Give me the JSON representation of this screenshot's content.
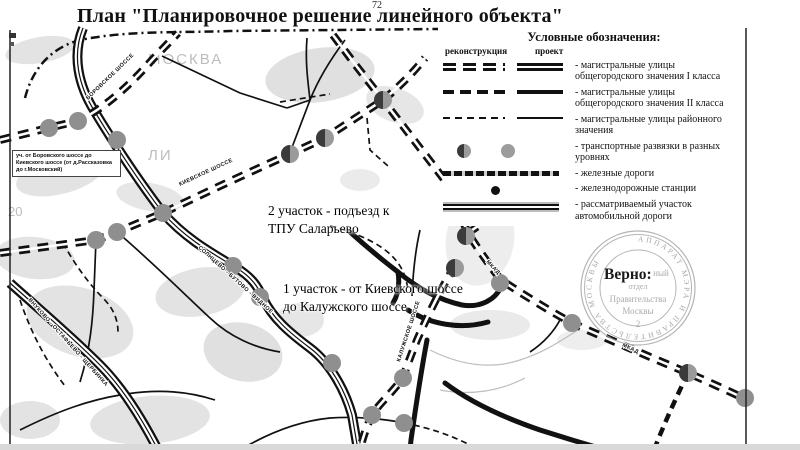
{
  "page": {
    "number": "72"
  },
  "title": "План \"Планировочное решение линейного объекта\"",
  "legend": {
    "title": "Условные обозначения:",
    "columns": {
      "reconstruction": "реконструкция",
      "project": "проект"
    },
    "items": [
      {
        "line1": "- магистральные улицы",
        "line2": "общегородского значения I класса"
      },
      {
        "line1": "- магистральные улицы",
        "line2": "общегородского значения II класса"
      },
      {
        "line1": "- магистральные улицы районного",
        "line2": "значения"
      },
      {
        "line1": "- транспортные развязки в разных уровнях",
        "line2": ""
      },
      {
        "line1": "- железные дороги",
        "line2": ""
      },
      {
        "line1": "- железнодорожные станции",
        "line2": ""
      },
      {
        "line1": "- рассматриваемый участок",
        "line2": "автомобильной дороги"
      }
    ]
  },
  "map": {
    "road_labels": {
      "borovskoe": "БОРОВСКОЕ ШОССЕ",
      "kievskoe": "КИЕВСКОЕ ШОССЕ",
      "kaluzhskoe": "КАЛУЖСКОЕ ШОССЕ",
      "profsoyuznaya": "ПРОФСОЮЗНАЯ УЛИЦА",
      "mkad1": "МКАД",
      "mkad2": "МКАД",
      "band_solntsevo": "СОЛНЦЕВО - БУТОВО - ВИДНОЕ",
      "band_vnukovo": "ВНУКОВО - ОСТАФЬЕВО - ЩЕРБИНКА",
      "bg_moskva": "МОСКВА",
      "bg_li": "ЛИ",
      "bg_num": "20"
    },
    "annotations": {
      "section2_line1": "2 участок - подъезд к",
      "section2_line2": "ТПУ Саларьево",
      "section1_line1": "1 участок - от Киевского шоссе",
      "section1_line2": "до Калужского шоссе",
      "left_note_line1": "уч. от Боровского шоссе до",
      "left_note_line2": "Киевского шоссе (от д.Рассказовка",
      "left_note_line3": "до г.Московский)"
    }
  },
  "stamp": {
    "verno": "Верно:",
    "ring": "АППАРАТ МЭРА И ПРАВИТЕЛЬСТВА МОСКВЫ",
    "line1": "ный",
    "line2": "отдел",
    "line3": "Правительства",
    "line4": "Москвы",
    "line5": "2"
  },
  "colors": {
    "road": "#111111",
    "interchange_gray": "#8f8f8f",
    "interchange_dark": "#3b3b3b",
    "urban": "#c7c7c7",
    "stamp": "#a8a8a8"
  }
}
